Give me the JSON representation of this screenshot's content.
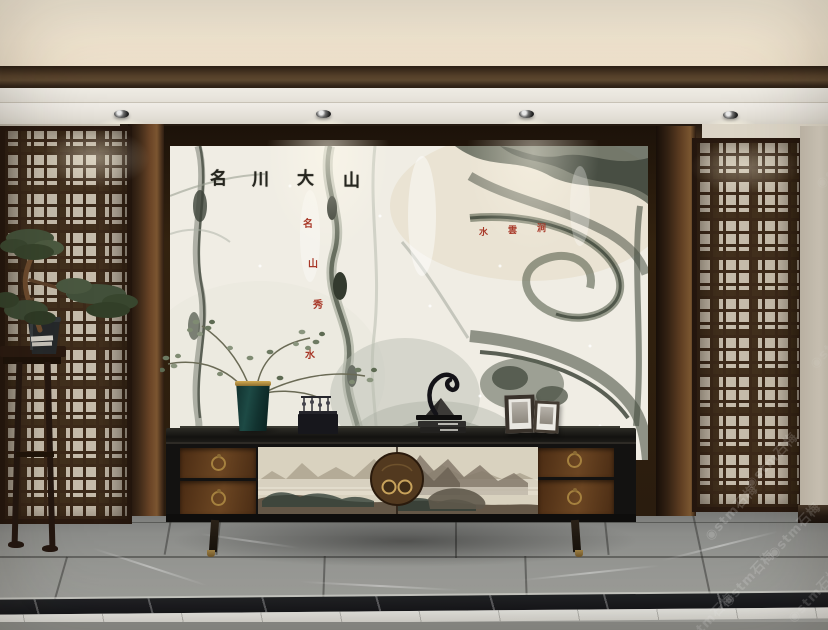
{
  "calligraphy": {
    "chars": [
      "名",
      "川",
      "大",
      "山"
    ],
    "ink_color": "#26261f"
  },
  "seals": {
    "left_column_chars": [
      "名",
      "山",
      "秀",
      "水"
    ],
    "right_row_chars": [
      "水",
      "雲",
      "涧"
    ],
    "seal_color": "#a83828"
  },
  "watermark": {
    "logo_glyph": "◉",
    "text": "stm石梅"
  },
  "palette": {
    "cove_light": "#f6ebd7",
    "beam_wood": "#3f2e1e",
    "wall_beige": "#d4cdbf",
    "lattice_wood": "#3d2a1a",
    "lattice_backing": "#c6bcab",
    "pillar_wood": "#5f3e22",
    "marble_base": "#f0ede4",
    "marble_vein": "#4a5143",
    "cabinet_black": "#131211",
    "drawer_wood": "#5a371c",
    "brass": "#a5813f",
    "vase_teal": "#1d4a45",
    "floor_gray": "#8c8d8a",
    "floor_border_black": "#1e2022",
    "floor_border_white": "#e9e8e3"
  },
  "counts": {
    "ceiling_spotlights": 4,
    "left_drawers": 2,
    "right_drawers": 2,
    "photo_frames": 2
  }
}
